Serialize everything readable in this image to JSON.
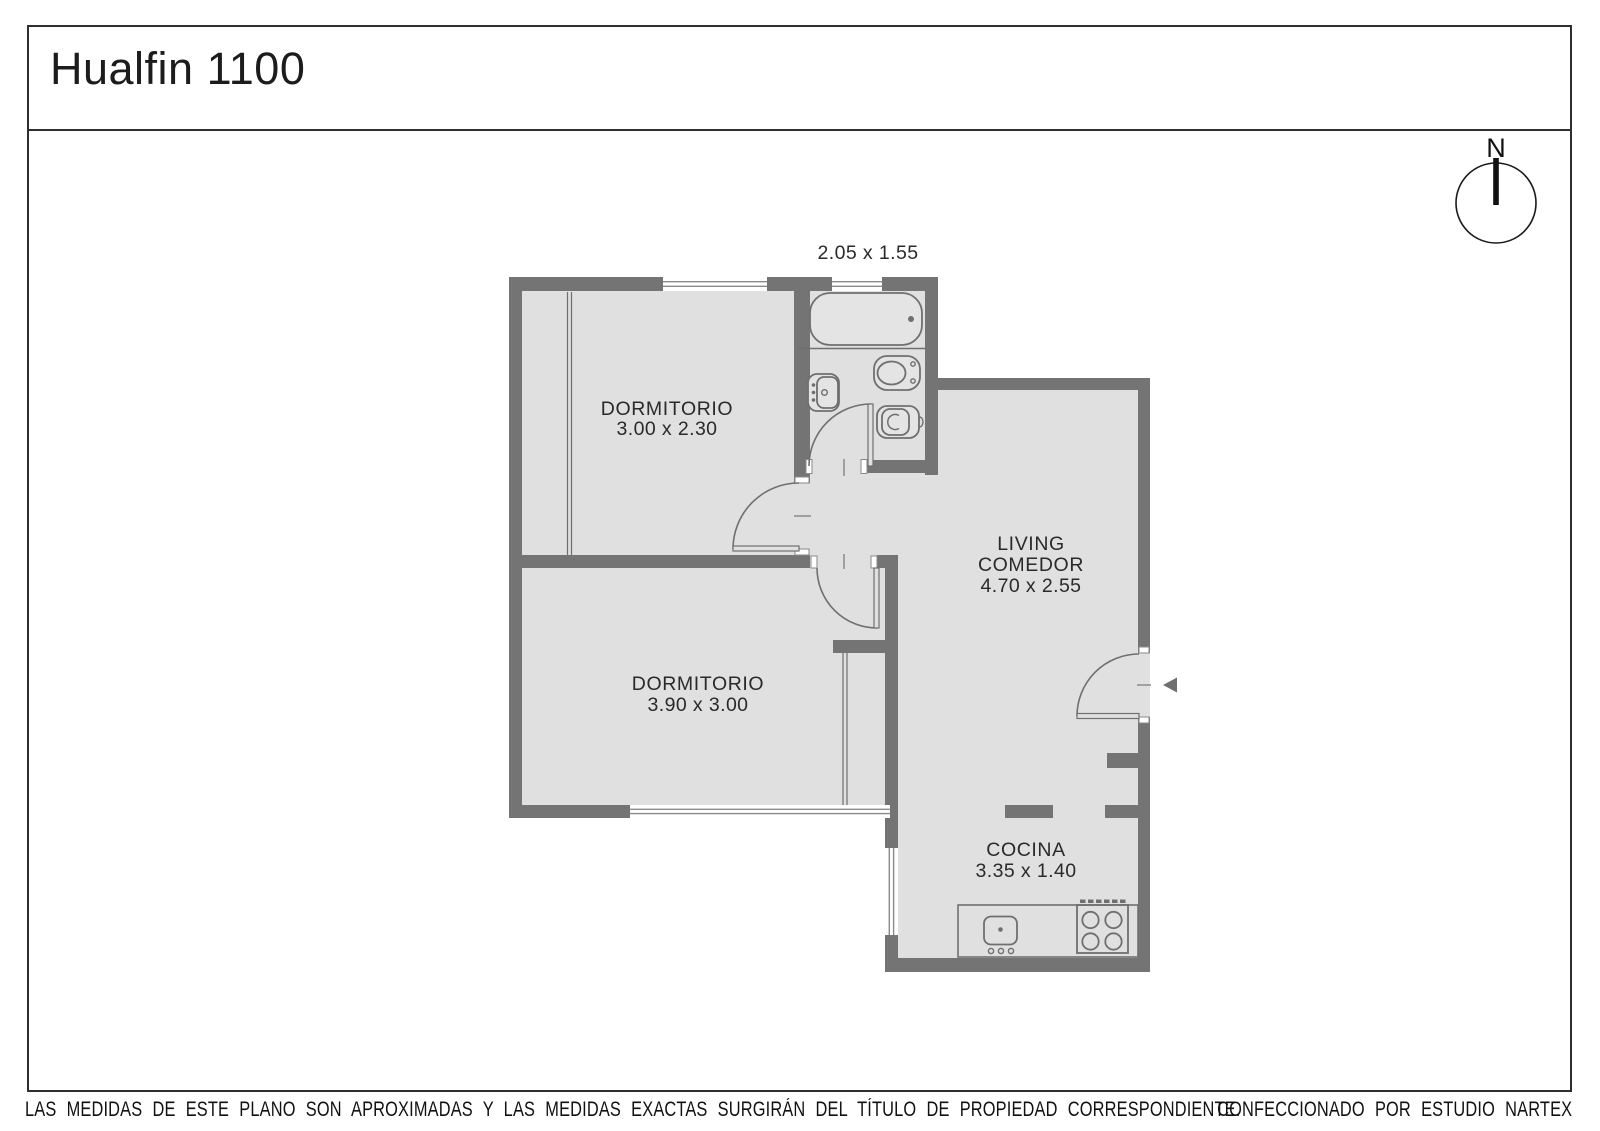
{
  "title": "Hualfin 1100",
  "compass": {
    "label": "N"
  },
  "plan": {
    "bathroom": {
      "dims": "2.05 x 1.55"
    },
    "bedroom1": {
      "name": "DORMITORIO",
      "dims": "3.00 x 2.30"
    },
    "bedroom2": {
      "name": "DORMITORIO",
      "dims": "3.90 x 3.00"
    },
    "living": {
      "line1": "LIVING",
      "line2": "COMEDOR",
      "dims": "4.70 x 2.55"
    },
    "kitchen": {
      "name": "COCINA",
      "dims": "3.35 x 1.40"
    }
  },
  "footer": {
    "disclaimer": "LAS MEDIDAS  DE ESTE PLANO SON APROXIMADAS Y LAS MEDIDAS EXACTAS SURGIRÁN DEL TÍTULO DE PROPIEDAD CORRESPONDIENTE.",
    "credit": "CONFECCIONADO POR ESTUDIO NARTEX"
  },
  "colors": {
    "wall": "#747474",
    "floor": "#e0e0e0",
    "fixture_stroke": "#6f6f6f",
    "window_line": "#8a8a8a",
    "border": "#2e2e2e",
    "text": "#2a2a2a"
  }
}
